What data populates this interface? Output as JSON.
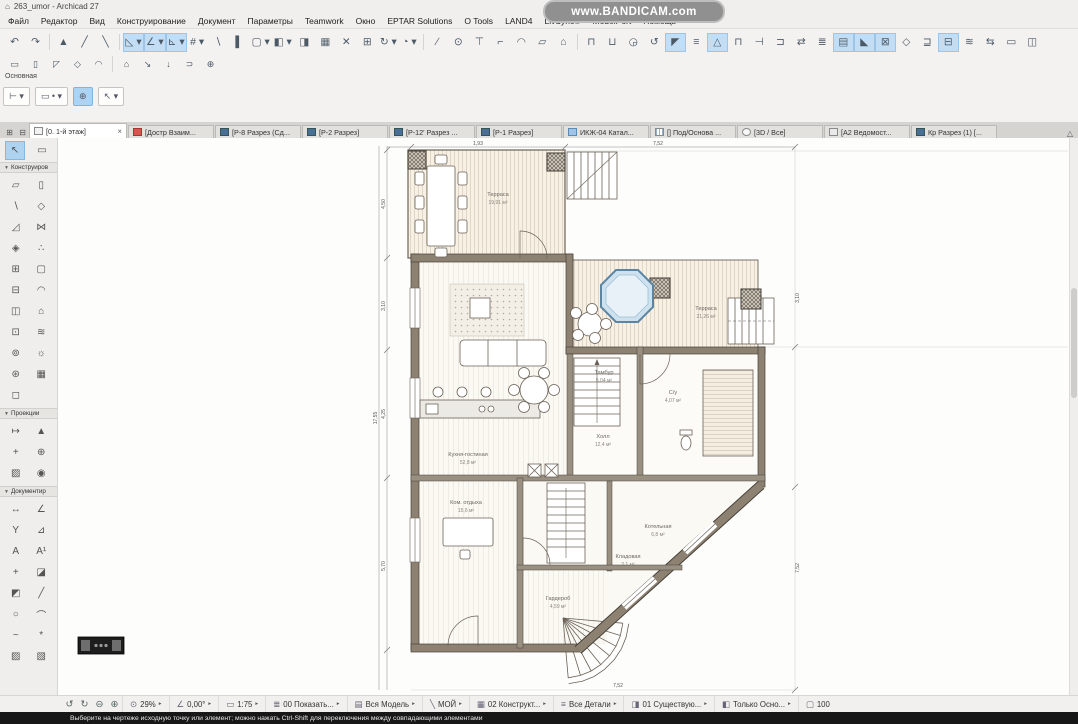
{
  "window": {
    "title": "263_umor - Archicad 27",
    "app_icon": "⌂",
    "watermark": "www.BANDICAM.com"
  },
  "menu": {
    "items": [
      "Файл",
      "Редактор",
      "Вид",
      "Конструирование",
      "Документ",
      "Параметры",
      "Teamwork",
      "Окно",
      "EPTAR Solutions",
      "O Tools",
      "LAND4",
      "LivSync®",
      "ModelPort",
      "Помощь"
    ]
  },
  "toolbar": {
    "row1": [
      {
        "g": "↶",
        "n": "undo-icon",
        "c": "tbtn",
        "i": "true"
      },
      {
        "g": "↷",
        "n": "redo-icon",
        "c": "tbtn",
        "i": "true"
      },
      {
        "g": "",
        "n": "separator",
        "c": "sep",
        "i": "false"
      },
      {
        "g": "▲",
        "n": "pin-icon",
        "c": "tbtn",
        "i": "true"
      },
      {
        "g": "╱",
        "n": "pen-icon",
        "c": "tbtn",
        "i": "true"
      },
      {
        "g": "╲",
        "n": "pick-up-parameters-icon",
        "c": "tbtn",
        "i": "true"
      },
      {
        "g": "",
        "n": "separator",
        "c": "sep",
        "i": "false"
      },
      {
        "g": "◺ ▾",
        "n": "guide-lines-icon",
        "c": "tbtn hl",
        "i": "true"
      },
      {
        "g": "∠ ▾",
        "n": "snap-guides-icon",
        "c": "tbtn hl",
        "i": "true"
      },
      {
        "g": "⊾ ▾",
        "n": "snap-points-icon",
        "c": "tbtn hl",
        "i": "true"
      },
      {
        "g": "# ▾",
        "n": "grid-snap-icon",
        "c": "tbtn",
        "i": "true"
      },
      {
        "g": "∖",
        "n": "cursor-snap-icon",
        "c": "tbtn",
        "i": "true"
      },
      {
        "g": "▌",
        "n": "gravity-icon",
        "c": "tbtn",
        "i": "true"
      },
      {
        "g": "▢ ▾",
        "n": "favorites-icon",
        "c": "tbtn",
        "i": "true"
      },
      {
        "g": "◧ ▾",
        "n": "element-settings-icon",
        "c": "tbtn",
        "i": "true"
      },
      {
        "g": "◨",
        "n": "pick-up-icon",
        "c": "tbtn",
        "i": "true"
      },
      {
        "g": "▦",
        "n": "inject-parameters-icon",
        "c": "tbtn",
        "i": "true"
      },
      {
        "g": "✕",
        "n": "eraser-icon",
        "c": "tbtn",
        "i": "true"
      },
      {
        "g": "⊞",
        "n": "modify-icon",
        "c": "tbtn",
        "i": "true"
      },
      {
        "g": "↻ ▾",
        "n": "rotate-icon",
        "c": "tbtn",
        "i": "true"
      },
      {
        "g": "◔ ▾",
        "n": "arc-segment-icon",
        "c": "tbtn",
        "i": "true"
      },
      {
        "g": "",
        "n": "separator",
        "c": "sep",
        "i": "false"
      },
      {
        "g": "∕",
        "n": "split-icon",
        "c": "tbtn",
        "i": "true"
      },
      {
        "g": "⊙",
        "n": "magnify-icon",
        "c": "tbtn",
        "i": "true"
      },
      {
        "g": "⊤",
        "n": "adjust-icon",
        "c": "tbtn",
        "i": "true"
      },
      {
        "g": "⌐",
        "n": "trim-icon",
        "c": "tbtn",
        "i": "true"
      },
      {
        "g": "◠",
        "n": "fillet-icon",
        "c": "tbtn",
        "i": "true"
      },
      {
        "g": "▱",
        "n": "offset-icon",
        "c": "tbtn",
        "i": "true"
      },
      {
        "g": "⌂",
        "n": "intersect-icon",
        "c": "tbtn",
        "i": "true"
      },
      {
        "g": "",
        "n": "separator",
        "c": "sep",
        "i": "false"
      },
      {
        "g": "⊓",
        "n": "wall-extras-icon",
        "c": "tbtn",
        "i": "true"
      },
      {
        "g": "⊔",
        "n": "roof-extras-icon",
        "c": "tbtn",
        "i": "true"
      },
      {
        "g": "◶",
        "n": "solid-operations-icon",
        "c": "tbtn",
        "i": "true"
      },
      {
        "g": "↺",
        "n": "orbit-icon",
        "c": "tbtn",
        "i": "true"
      },
      {
        "g": "◤",
        "n": "corner-window-icon",
        "c": "tbtn hl",
        "i": "true"
      },
      {
        "g": "≡",
        "n": "layer-settings-icon",
        "c": "tbtn",
        "i": "true"
      },
      {
        "g": "△",
        "n": "mark-up-icon",
        "c": "tbtn hl",
        "i": "true"
      },
      {
        "g": "⊓",
        "n": "dimension-style-icon",
        "c": "tbtn",
        "i": "true"
      },
      {
        "g": "⊣",
        "n": "align-icon",
        "c": "tbtn",
        "i": "true"
      },
      {
        "g": "⊐",
        "n": "distribute-icon",
        "c": "tbtn",
        "i": "true"
      },
      {
        "g": "⇄",
        "n": "mirror-icon",
        "c": "tbtn",
        "i": "true"
      },
      {
        "g": "≣",
        "n": "stories-icon",
        "c": "tbtn",
        "i": "true"
      },
      {
        "g": "▤",
        "n": "section-marker-icon",
        "c": "tbtn hl",
        "i": "true"
      },
      {
        "g": "◣",
        "n": "camera-path-icon",
        "c": "tbtn hl",
        "i": "true"
      },
      {
        "g": "⊠",
        "n": "marquee-operations-icon",
        "c": "tbtn hl",
        "i": "true"
      },
      {
        "g": "◇",
        "n": "morph-operations-icon",
        "c": "tbtn",
        "i": "true"
      },
      {
        "g": "⊒",
        "n": "renovation-status-icon",
        "c": "tbtn",
        "i": "true"
      },
      {
        "g": "⊟",
        "n": "virtual-trace-icon",
        "c": "tbtn hl",
        "i": "true"
      },
      {
        "g": "≋",
        "n": "surface-painter-icon",
        "c": "tbtn",
        "i": "true"
      },
      {
        "g": "⇆",
        "n": "swap-reference-icon",
        "c": "tbtn",
        "i": "true"
      },
      {
        "g": "▭",
        "n": "bounding-box-icon",
        "c": "tbtn",
        "i": "true"
      },
      {
        "g": "◫",
        "n": "window-arrange-icon",
        "c": "tbtn",
        "i": "true"
      }
    ],
    "row2": [
      {
        "g": "▭",
        "n": "wall-quick-icon",
        "c": "tbtn",
        "i": "true"
      },
      {
        "g": "▯",
        "n": "column-quick-icon",
        "c": "tbtn",
        "i": "true"
      },
      {
        "g": "◸",
        "n": "roof-quick-icon",
        "c": "tbtn",
        "i": "true"
      },
      {
        "g": "◇",
        "n": "slab-quick-icon",
        "c": "tbtn",
        "i": "true"
      },
      {
        "g": "◠",
        "n": "arc-quick-icon",
        "c": "tbtn",
        "i": "true"
      },
      {
        "g": "",
        "n": "separator",
        "c": "sep",
        "i": "false"
      },
      {
        "g": "⌂",
        "n": "object-quick-icon",
        "c": "tbtn",
        "i": "true"
      },
      {
        "g": "↘",
        "n": "leader-quick-icon",
        "c": "tbtn",
        "i": "true"
      },
      {
        "g": "↓",
        "n": "drop-quick-icon",
        "c": "tbtn",
        "i": "true"
      },
      {
        "g": "⊃",
        "n": "hook-quick-icon",
        "c": "tbtn",
        "i": "true"
      },
      {
        "g": "⊕",
        "n": "target-quick-icon",
        "c": "tbtn",
        "i": "true"
      }
    ],
    "infobar_label": "Основная",
    "mini": [
      {
        "g": "⊢ ▾",
        "n": "reference-line-button",
        "c": "mbtn",
        "i": "true"
      },
      {
        "g": "▭ • ▾",
        "n": "geometry-method-button",
        "c": "mbtn",
        "i": "true"
      },
      {
        "g": "⊕",
        "n": "magic-wand-button",
        "c": "mbtn hl",
        "i": "true"
      },
      {
        "g": "↖ ▾",
        "n": "arrow-tool-button",
        "c": "mbtn",
        "i": "true"
      }
    ]
  },
  "tabs": {
    "win_buttons": [
      {
        "g": "⊞",
        "n": "pop-up-navigator-button",
        "c": "winbtn",
        "i": "true"
      },
      {
        "g": "⊟",
        "n": "organize-tabs-button",
        "c": "winbtn",
        "i": "true"
      }
    ],
    "active": {
      "label": "[0. 1-й этаж]",
      "close": "×"
    },
    "items": [
      {
        "cls": "tab",
        "icls": "ti ti-person",
        "label": "[Достр Взаим...",
        "n": "tab-dostr-vzaim"
      },
      {
        "cls": "tab",
        "icls": "ti ti-sec",
        "label": "[Р-8 Разрез (Сд...",
        "n": "tab-p8-razrez"
      },
      {
        "cls": "tab",
        "icls": "ti ti-sec",
        "label": "[Р-2 Разрез]",
        "n": "tab-p2-razrez"
      },
      {
        "cls": "tab",
        "icls": "ti ti-sec",
        "label": "[Р-12' Разрез ...",
        "n": "tab-p12-razrez"
      },
      {
        "cls": "tab",
        "icls": "ti ti-sec",
        "label": "[Р-1 Разрез]",
        "n": "tab-p1-razrez"
      },
      {
        "cls": "tab",
        "icls": "ti ti-blue",
        "label": "ИКЖ-04 Катал...",
        "n": "tab-ikzh-04-katalog"
      },
      {
        "cls": "tab",
        "icls": "ti ti-grid",
        "label": "[] Под/Основа ...",
        "n": "tab-pod-osnova"
      },
      {
        "cls": "tab",
        "icls": "ti ti-3d",
        "label": "[3D / Все]",
        "n": "tab-3d-vse"
      },
      {
        "cls": "tab",
        "icls": "ti ti-layout",
        "label": "[А2 Ведомост...",
        "n": "tab-a2-vedomost"
      },
      {
        "cls": "tab",
        "icls": "ti ti-sec",
        "label": "Кр Разрез (1) [...",
        "n": "tab-kr-razrez"
      }
    ],
    "overflow": "△"
  },
  "toolbox": {
    "select_tools": [
      {
        "g": "↖",
        "n": "arrow-tool",
        "c": "tool sel",
        "i": "true"
      },
      {
        "g": "▭",
        "n": "marquee-tool",
        "c": "tool",
        "i": "true"
      }
    ],
    "sections": [
      {
        "title": "Конструиров",
        "tools": [
          {
            "g": "▱",
            "n": "wall-tool",
            "i": "true"
          },
          {
            "g": "▯",
            "n": "column-tool",
            "i": "true"
          },
          {
            "g": "∖",
            "n": "beam-tool",
            "i": "true"
          },
          {
            "g": "◇",
            "n": "slab-tool",
            "i": "true"
          },
          {
            "g": "◿",
            "n": "roof-tool",
            "i": "true"
          },
          {
            "g": "⋈",
            "n": "shell-tool",
            "i": "true"
          },
          {
            "g": "◈",
            "n": "complex-roof-tool",
            "i": "true"
          },
          {
            "g": "∴",
            "n": "mesh-point-tool",
            "i": "true"
          },
          {
            "g": "⊞",
            "n": "curtain-wall-tool",
            "i": "true"
          },
          {
            "g": "▢",
            "n": "opening-tool",
            "i": "true"
          },
          {
            "g": "⊟",
            "n": "stair-tool",
            "i": "true"
          },
          {
            "g": "◠",
            "n": "railing-tool",
            "i": "true"
          },
          {
            "g": "◫",
            "n": "window-tool",
            "i": "true"
          },
          {
            "g": "⌂",
            "n": "skylight-tool",
            "i": "true"
          },
          {
            "g": "⊡",
            "n": "door-tool",
            "i": "true"
          },
          {
            "g": "≋",
            "n": "mesh-tool",
            "i": "true"
          },
          {
            "g": "⊚",
            "n": "object-tool",
            "i": "true"
          },
          {
            "g": "☼",
            "n": "lamp-tool",
            "i": "true"
          },
          {
            "g": "⊛",
            "n": "morph-tool",
            "i": "true"
          },
          {
            "g": "▦",
            "n": "zone-tool",
            "i": "true"
          },
          {
            "g": "◻",
            "n": "ending-tool",
            "i": "true"
          }
        ]
      },
      {
        "title": "Проекции",
        "tools": [
          {
            "g": "↦",
            "n": "section-tool",
            "i": "true"
          },
          {
            "g": "▲",
            "n": "elevation-tool",
            "i": "true"
          },
          {
            "g": "+",
            "n": "interior-elevation-tool",
            "i": "true"
          },
          {
            "g": "⊕",
            "n": "worksheet-tool",
            "i": "true"
          },
          {
            "g": "▨",
            "n": "detail-tool",
            "i": "true"
          },
          {
            "g": "◉",
            "n": "camera-tool",
            "i": "true"
          }
        ]
      },
      {
        "title": "Документир",
        "tools": [
          {
            "g": "↔",
            "n": "dimension-tool",
            "i": "true"
          },
          {
            "g": "∠",
            "n": "angle-dimension-tool",
            "i": "true"
          },
          {
            "g": "Y",
            "n": "level-dimension-tool",
            "i": "true"
          },
          {
            "g": "⊿",
            "n": "radial-dimension-tool",
            "i": "true"
          },
          {
            "g": "A",
            "n": "text-tool",
            "i": "true"
          },
          {
            "g": "A¹",
            "n": "label-tool",
            "i": "true"
          },
          {
            "g": "+",
            "n": "hotspot-tool",
            "i": "true"
          },
          {
            "g": "◪",
            "n": "fill-tool",
            "i": "true"
          },
          {
            "g": "◩",
            "n": "polygon-tool",
            "i": "true"
          },
          {
            "g": "╱",
            "n": "line-tool",
            "i": "true"
          },
          {
            "g": "○",
            "n": "circle-tool",
            "i": "true"
          },
          {
            "g": "⌒",
            "n": "arc-tool",
            "i": "true"
          },
          {
            "g": "~",
            "n": "spline-tool",
            "i": "true"
          },
          {
            "g": "*",
            "n": "hotlink-tool",
            "i": "true"
          },
          {
            "g": "▨",
            "n": "figure-tool",
            "i": "true"
          },
          {
            "g": "▧",
            "n": "drawing-tool",
            "i": "true"
          }
        ]
      }
    ]
  },
  "canvas": {
    "plan": {
      "rooms": {
        "terrace_top": {
          "name": "Терраса",
          "area": "19,91 м²"
        },
        "terrace_right": {
          "name": "Терраса",
          "area": "21,26 м²"
        },
        "living": {
          "name": "Кухня-гостиная",
          "area": "52,8 м²"
        },
        "hall": {
          "name": "Холл",
          "area": "12,4 м²"
        },
        "tambur": {
          "name": "Тамбур",
          "area": "5,04 м²"
        },
        "wc": {
          "name": "С/у",
          "area": "4,07 м²"
        },
        "boiler": {
          "name": "Котельная",
          "area": "6,8 м²"
        },
        "lounge": {
          "name": "Ком. отдыха",
          "area": "15,6 м²"
        },
        "wardrobe": {
          "name": "Гардероб",
          "area": "4,59 м²"
        },
        "storage": {
          "name": "Кладовая",
          "area": "2,1 м²"
        }
      },
      "dims": {
        "left": [
          "4,50",
          "3,10",
          "4,25",
          "5,70"
        ],
        "left_total": "17,55",
        "top": [
          "1,93",
          "7,52"
        ],
        "right": [
          "3,10",
          "7,52"
        ],
        "bottom": [
          "7,52"
        ]
      }
    }
  },
  "statusbar": {
    "nav_icons": [
      {
        "g": "↺",
        "n": "fit-in-window-icon",
        "i": "true"
      },
      {
        "g": "↻",
        "n": "previous-zoom-icon",
        "i": "true"
      },
      {
        "g": "⊖",
        "n": "zoom-out-icon",
        "i": "true"
      },
      {
        "g": "⊕",
        "n": "zoom-in-icon",
        "i": "true"
      }
    ],
    "segments": [
      {
        "ic": "⊙",
        "label": "29%",
        "arr": "▸",
        "n": "zoom-level-select",
        "i": "true"
      },
      {
        "ic": "∠",
        "label": "0,00°",
        "arr": "▸",
        "n": "orientation-select",
        "i": "true"
      },
      {
        "ic": "▭",
        "label": "1:75",
        "arr": "▸",
        "n": "scale-select",
        "i": "true"
      },
      {
        "ic": "≣",
        "label": "00 Показать...",
        "arr": "▸",
        "n": "layer-combination-select",
        "i": "true"
      },
      {
        "ic": "▤",
        "label": "Вся Модель",
        "arr": "▸",
        "n": "structure-display-select",
        "i": "true"
      },
      {
        "ic": "╲",
        "label": "МОЙ",
        "arr": "▸",
        "n": "pen-set-select",
        "i": "true"
      },
      {
        "ic": "▦",
        "label": "02 Конструкт...",
        "arr": "▸",
        "n": "model-view-options-select",
        "i": "true"
      },
      {
        "ic": "≡",
        "label": "Все Детали",
        "arr": "▸",
        "n": "detail-level-select",
        "i": "true"
      },
      {
        "ic": "◨",
        "label": "01 Существую...",
        "arr": "▸",
        "n": "graphic-override-select",
        "i": "true"
      },
      {
        "ic": "◧",
        "label": "Только Осно...",
        "arr": "▸",
        "n": "renovation-filter-select",
        "i": "true"
      },
      {
        "ic": "▢",
        "label": "100",
        "arr": "",
        "n": "position-indicator",
        "i": "false"
      }
    ]
  },
  "hintbar": {
    "text": "Выберите на чертеже исходную точку или элемент; можно нажать Ctrl-Shift для переключения между совпадающими элементами"
  }
}
